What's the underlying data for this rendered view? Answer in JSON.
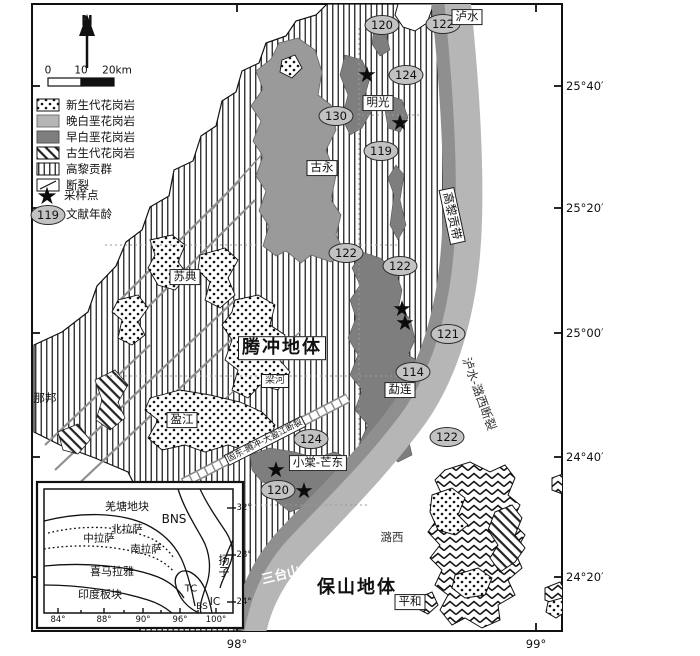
{
  "compass": {
    "label": "N"
  },
  "scalebar": {
    "t0": "0",
    "t1": "10",
    "t2": "20km"
  },
  "legend": {
    "age_example": "119",
    "items": [
      {
        "label": "新生代花岗岩"
      },
      {
        "label": "晚白垩花岗岩"
      },
      {
        "label": "早白垩花岗岩"
      },
      {
        "label": "古生代花岗岩"
      },
      {
        "label": "高黎贡群"
      },
      {
        "label": "断裂"
      },
      {
        "label": "采样点"
      },
      {
        "label": "文献年龄"
      }
    ]
  },
  "axes": {
    "right": [
      {
        "label": "25°40′"
      },
      {
        "label": "25°20′"
      },
      {
        "label": "25°00′"
      },
      {
        "label": "24°40′"
      },
      {
        "label": "24°20′"
      }
    ],
    "bottom": [
      {
        "label": "98°"
      },
      {
        "label": "99°"
      }
    ]
  },
  "ages": [
    {
      "v": "120"
    },
    {
      "v": "122"
    },
    {
      "v": "124"
    },
    {
      "v": "130"
    },
    {
      "v": "119"
    },
    {
      "v": "122"
    },
    {
      "v": "122"
    },
    {
      "v": "121"
    },
    {
      "v": "114"
    },
    {
      "v": "122"
    },
    {
      "v": "124"
    },
    {
      "v": "120"
    }
  ],
  "places": {
    "lushui": "泸水",
    "mingguang": "明光",
    "guyong": "古永",
    "sudian": "苏典",
    "tengchong_terrane": "腾冲地体",
    "nabang": "那邦",
    "yingjiang": "盈江",
    "lianghe": "梁河",
    "menglian": "勐连",
    "xiaotang_mangdong": "小棠-芒东",
    "santaishan": "三台山",
    "luxi": "潞西",
    "baoshan_terrane": "保山地体",
    "pinghe": "平和",
    "gaoligong_belt": "高黎贡带",
    "lushui_luxi_fault": "泸水-潞西断裂",
    "gudong_fault": "固东-腾冲-大盈江断裂"
  },
  "inset": {
    "labels": {
      "qiangtang": "羌塘地块",
      "bns": "BNS",
      "north_lhasa": "北拉萨",
      "central_lhasa": "中拉萨",
      "south_lhasa": "南拉萨",
      "yangtze": "扬子",
      "himalaya": "喜马拉雅",
      "india": "印度板块",
      "tc": "TC",
      "bs": "BS",
      "ic": "IC"
    },
    "x_ticks": [
      {
        "label": "84°"
      },
      {
        "label": "88°"
      },
      {
        "label": "90°"
      },
      {
        "label": "96°"
      },
      {
        "label": "100°"
      }
    ],
    "y_ticks": [
      {
        "label": "32°"
      },
      {
        "label": "28°"
      },
      {
        "label": "24°"
      }
    ]
  },
  "colors": {
    "late_cretaceous": "#b6b6b6",
    "early_cretaceous": "#7e7e7e",
    "guyong_gray": "#9a9a9a",
    "oval_fill": "#c2c2c2"
  }
}
